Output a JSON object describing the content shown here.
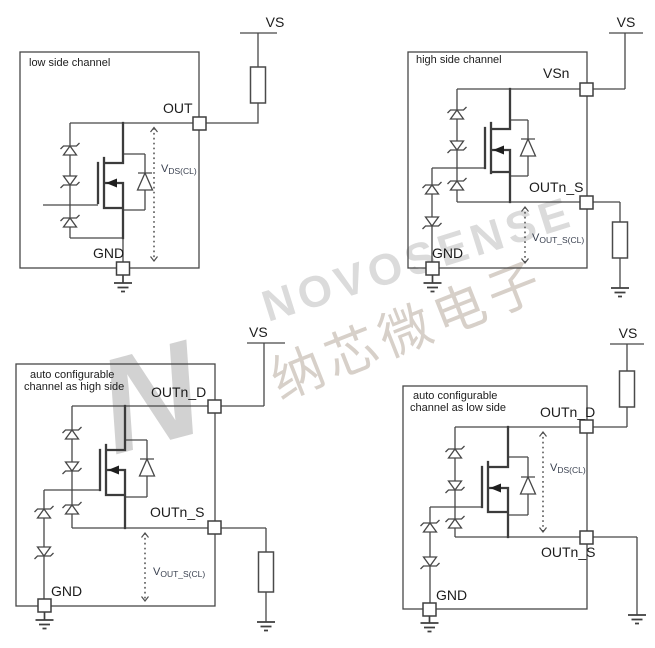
{
  "watermark": {
    "logo_letter": "N",
    "brand": "NOVOSENSE",
    "brand_cn": "纳芯微电子"
  },
  "circuits": {
    "low_side": {
      "title": "low side channel",
      "supply_label": "VS",
      "out_label": "OUT",
      "gnd_label": "GND",
      "measure_prefix": "V",
      "measure_sub": "DS(CL)"
    },
    "high_side": {
      "title": "high side  channel",
      "supply_label": "VS",
      "vsn_label": "VSn",
      "out_s_label": "OUTn_S",
      "gnd_label": "GND",
      "measure_prefix": "V",
      "measure_sub": "OUT_S(CL)"
    },
    "auto_high_side": {
      "title_line1": "auto configurable",
      "title_line2": "channel as high side",
      "supply_label": "VS",
      "out_d_label": "OUTn_D",
      "out_s_label": "OUTn_S",
      "gnd_label": "GND",
      "measure_prefix": "V",
      "measure_sub": "OUT_S(CL)"
    },
    "auto_low_side": {
      "title_line1": "auto configurable",
      "title_line2": "channel as low side",
      "supply_label": "VS",
      "out_d_label": "OUTn_D",
      "out_s_label": "OUTn_S",
      "gnd_label": "GND",
      "measure_prefix": "V",
      "measure_sub": "DS(CL)"
    }
  },
  "colors": {
    "line": "#474747",
    "text": "#1c1c1c",
    "measure_text": "#3a4150",
    "watermark_latin": "#dbdbdb",
    "watermark_cn": "#d7d0c9",
    "watermark_logo": "#d2d2d2"
  }
}
